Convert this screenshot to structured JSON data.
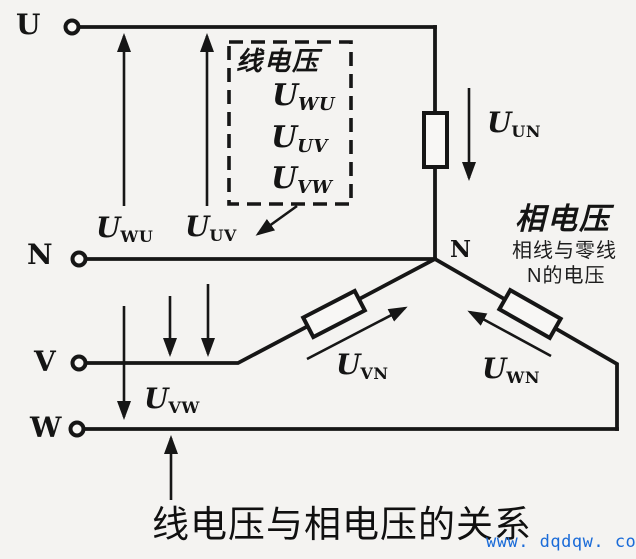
{
  "colors": {
    "ink": "#161616",
    "background": "#f4f3f1",
    "component_fill": "#f8f7f5",
    "watermark_blue": "#1a6bd8"
  },
  "terminals": {
    "u": "U",
    "n": "N",
    "v": "V",
    "w": "W"
  },
  "neutral_node_label": "N",
  "line_voltage_box": {
    "title": "线电压",
    "items": [
      {
        "main": "U",
        "sub": "WU"
      },
      {
        "main": "U",
        "sub": "UV"
      },
      {
        "main": "U",
        "sub": "VW"
      }
    ]
  },
  "voltage_labels": {
    "uwu": {
      "main": "U",
      "sub": "WU"
    },
    "uuv": {
      "main": "U",
      "sub": "UV"
    },
    "uvw": {
      "main": "U",
      "sub": "VW"
    },
    "uun": {
      "main": "U",
      "sub": "UN"
    },
    "uvn": {
      "main": "U",
      "sub": "VN"
    },
    "uwn": {
      "main": "U",
      "sub": "WN"
    }
  },
  "phase_voltage_note": {
    "title": "相电压",
    "line1": "相线与零线",
    "line2": "N的电压"
  },
  "caption": "线电压与相电压的关系",
  "watermark": "www. dqdqw. com"
}
